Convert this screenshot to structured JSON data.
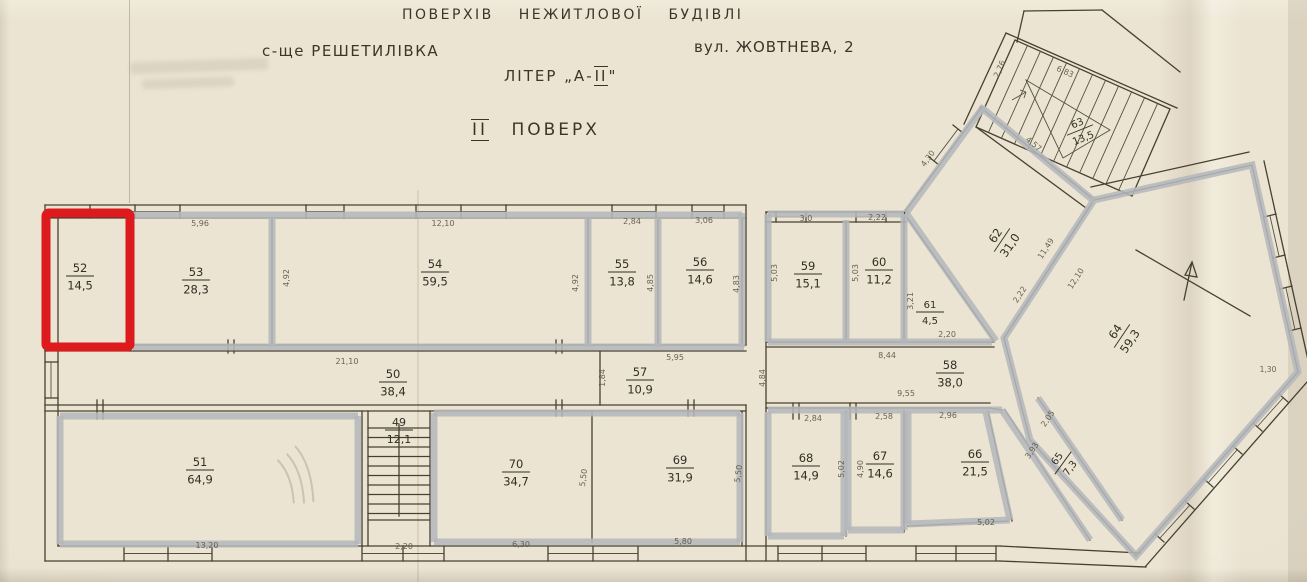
{
  "document": {
    "title_line": "ПОВЕРХІВ НЕЖИТЛОВОЇ БУДІВЛІ",
    "settlement": "с-ще РЕШЕТИЛІВКА",
    "address": "вул. ЖОВТНЕВА, 2",
    "liter_prefix": "ЛІТЕР „А-",
    "liter_roman": "ІІ",
    "liter_suffix": "\"",
    "floor_roman": "ІІ",
    "floor_word": "ПОВЕРХ"
  },
  "highlight": {
    "selected_room": "52",
    "selection_color": "#dd1a1d",
    "wall_highlight_color": "#b4b7bb"
  },
  "rooms": [
    {
      "number": "49",
      "area": "12,1"
    },
    {
      "number": "50",
      "area": "38,4"
    },
    {
      "number": "51",
      "area": "64,9"
    },
    {
      "number": "52",
      "area": "14,5"
    },
    {
      "number": "53",
      "area": "28,3"
    },
    {
      "number": "54",
      "area": "59,5"
    },
    {
      "number": "55",
      "area": "13,8"
    },
    {
      "number": "56",
      "area": "14,6"
    },
    {
      "number": "57",
      "area": "10,9"
    },
    {
      "number": "58",
      "area": "38,0"
    },
    {
      "number": "59",
      "area": "15,1"
    },
    {
      "number": "60",
      "area": "11,2"
    },
    {
      "number": "61",
      "area": "4,5"
    },
    {
      "number": "62",
      "area": "31,0"
    },
    {
      "number": "63",
      "area": "13,5"
    },
    {
      "number": "64",
      "area": "59,3"
    },
    {
      "number": "65",
      "area": "7,3"
    },
    {
      "number": "66",
      "area": "21,5"
    },
    {
      "number": "67",
      "area": "14,6"
    },
    {
      "number": "68",
      "area": "14,9"
    },
    {
      "number": "69",
      "area": "31,9"
    },
    {
      "number": "70",
      "area": "34,7"
    }
  ],
  "dimensions": [
    {
      "id": "d53_top",
      "text": "5,96"
    },
    {
      "id": "d54_top",
      "text": "12,10"
    },
    {
      "id": "d55_top",
      "text": "2,84"
    },
    {
      "id": "d56_top",
      "text": "3,06"
    },
    {
      "id": "d59_top",
      "text": "3,0"
    },
    {
      "id": "d60_top",
      "text": "2,22"
    },
    {
      "id": "d53_r",
      "text": "4,92"
    },
    {
      "id": "d54_r",
      "text": "4,92"
    },
    {
      "id": "d55_r",
      "text": "4,85"
    },
    {
      "id": "d56_r",
      "text": "4,83"
    },
    {
      "id": "d59_l",
      "text": "5,03"
    },
    {
      "id": "d60_l",
      "text": "5,03"
    },
    {
      "id": "d61_s",
      "text": "3,21"
    },
    {
      "id": "d61_b",
      "text": "2,20"
    },
    {
      "id": "d50",
      "text": "21,10"
    },
    {
      "id": "d57_top",
      "text": "5,95"
    },
    {
      "id": "d57_l",
      "text": "1,84"
    },
    {
      "id": "d58_l",
      "text": "4,84"
    },
    {
      "id": "d58_a",
      "text": "8,44"
    },
    {
      "id": "d58_b",
      "text": "9,55"
    },
    {
      "id": "d49_b",
      "text": "2,20"
    },
    {
      "id": "d51_b",
      "text": "13,20"
    },
    {
      "id": "d70_b",
      "text": "6,30"
    },
    {
      "id": "d69_b",
      "text": "5,80"
    },
    {
      "id": "d70_r",
      "text": "5,50"
    },
    {
      "id": "d69_r",
      "text": "5,50"
    },
    {
      "id": "d68_top",
      "text": "2,84"
    },
    {
      "id": "d67_top",
      "text": "2,58"
    },
    {
      "id": "d66_top",
      "text": "2,96"
    },
    {
      "id": "d66_b",
      "text": "5,02"
    },
    {
      "id": "d68_r",
      "text": "5,02"
    },
    {
      "id": "d67_l",
      "text": "4,90"
    },
    {
      "id": "d62_tl",
      "text": "4,30"
    },
    {
      "id": "d62_tr",
      "text": "4,57"
    },
    {
      "id": "d62_br",
      "text": "11,49"
    },
    {
      "id": "d62_b2",
      "text": "2,22"
    },
    {
      "id": "d64_l",
      "text": "12,10"
    },
    {
      "id": "d63_l",
      "text": "2,76"
    },
    {
      "id": "d63_m",
      "text": "6,83"
    },
    {
      "id": "d65_a",
      "text": "3,93"
    },
    {
      "id": "d65_b",
      "text": "2,05"
    },
    {
      "id": "d64_e",
      "text": "1,30"
    }
  ]
}
